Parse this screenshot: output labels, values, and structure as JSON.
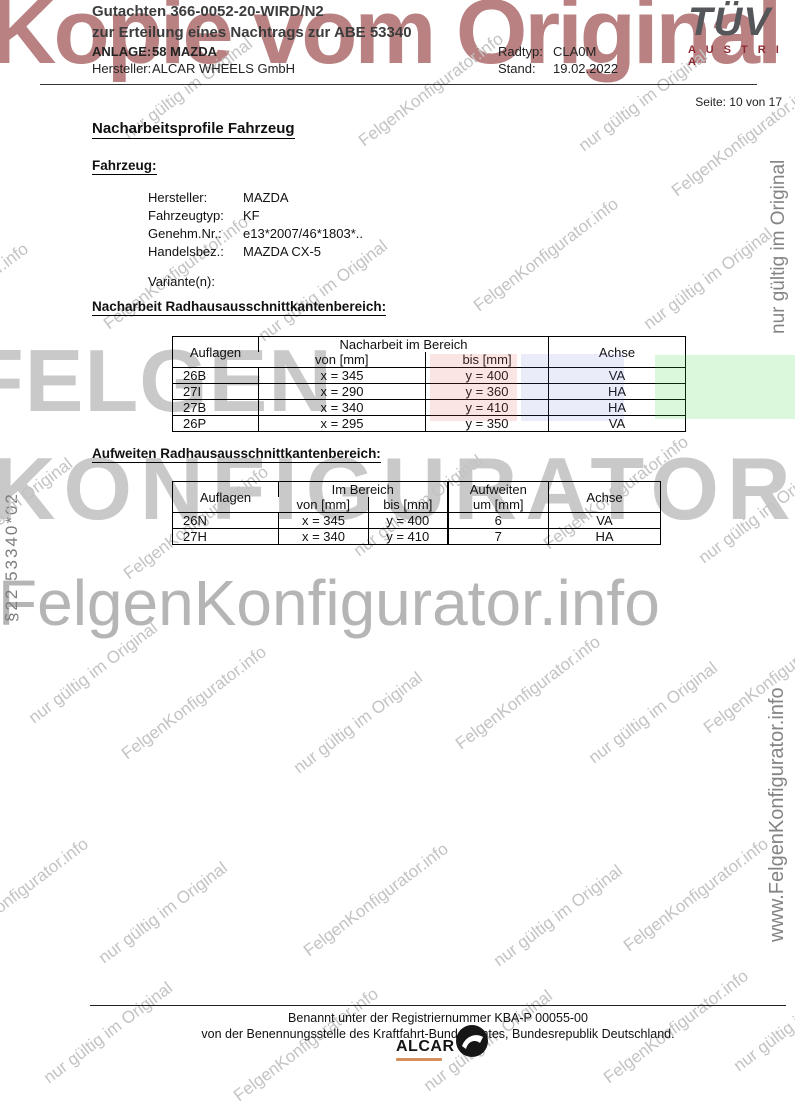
{
  "header": {
    "title_line1": "Gutachten 366-0052-20-WIRD/N2",
    "title_line2": "zur Erteilung eines Nachtrags zur ABE 53340",
    "anlage_label": "ANLAGE:",
    "anlage_value": "58 MAZDA",
    "hersteller_label": "Hersteller:",
    "hersteller_value": "ALCAR WHEELS GmbH",
    "radtyp_label": "Radtyp:",
    "radtyp_value": "CLA0M",
    "stand_label": "Stand:",
    "stand_value": "19.02.2022",
    "page_info": "Seite: 10 von 17"
  },
  "logo": {
    "tuv": "TÜV",
    "austria": "A U S T R I A"
  },
  "watermarks": {
    "kopie": "Kopie vom Original",
    "felgen_line1": "FELGEN",
    "felgen_line2": "KONFIGURATOR",
    "felgen_info_large": "FelgenKonfigurator.info",
    "left_vertical": "§22  53340*02",
    "right_vertical_top": "nur gültig im Original",
    "right_vertical_bottom": "www.FelgenKonfigurator.info",
    "diag_texts": {
      "n": "nur gültig im Original",
      "f": "FelgenKonfigurator.info"
    },
    "diag_items": [
      {
        "t": "f",
        "x": -150,
        "y": 190
      },
      {
        "t": "n",
        "x": 120,
        "y": 128
      },
      {
        "t": "f",
        "x": 355,
        "y": 135
      },
      {
        "t": "n",
        "x": 575,
        "y": 140
      },
      {
        "t": "f",
        "x": 668,
        "y": 185
      },
      {
        "t": "f",
        "x": -120,
        "y": 345
      },
      {
        "t": "f",
        "x": 100,
        "y": 318
      },
      {
        "t": "n",
        "x": 255,
        "y": 330
      },
      {
        "t": "f",
        "x": 470,
        "y": 300
      },
      {
        "t": "n",
        "x": 640,
        "y": 318
      },
      {
        "t": "n",
        "x": -60,
        "y": 548
      },
      {
        "t": "f",
        "x": 120,
        "y": 568
      },
      {
        "t": "n",
        "x": 350,
        "y": 545
      },
      {
        "t": "f",
        "x": 540,
        "y": 538
      },
      {
        "t": "n",
        "x": 695,
        "y": 552
      },
      {
        "t": "n",
        "x": 25,
        "y": 712
      },
      {
        "t": "f",
        "x": 118,
        "y": 748
      },
      {
        "t": "n",
        "x": 290,
        "y": 762
      },
      {
        "t": "f",
        "x": 452,
        "y": 738
      },
      {
        "t": "n",
        "x": 585,
        "y": 752
      },
      {
        "t": "f",
        "x": 700,
        "y": 722
      },
      {
        "t": "f",
        "x": -60,
        "y": 940
      },
      {
        "t": "n",
        "x": 95,
        "y": 952
      },
      {
        "t": "f",
        "x": 300,
        "y": 945
      },
      {
        "t": "n",
        "x": 490,
        "y": 955
      },
      {
        "t": "f",
        "x": 620,
        "y": 940
      },
      {
        "t": "n",
        "x": 40,
        "y": 1072
      },
      {
        "t": "f",
        "x": 230,
        "y": 1090
      },
      {
        "t": "n",
        "x": 420,
        "y": 1080
      },
      {
        "t": "f",
        "x": 600,
        "y": 1072
      },
      {
        "t": "n",
        "x": 730,
        "y": 1060
      }
    ]
  },
  "content": {
    "page_title": "Nacharbeitsprofile Fahrzeug",
    "fahrzeug_heading": "Fahrzeug:",
    "fahrzeug_fields": [
      {
        "label": "Hersteller:",
        "value": "MAZDA"
      },
      {
        "label": "Fahrzeugtyp:",
        "value": "KF"
      },
      {
        "label": "Genehm.Nr.:",
        "value": "e13*2007/46*1803*.."
      },
      {
        "label": "Handelsbez.:",
        "value": "MAZDA CX-5"
      }
    ],
    "varianten_label": "Variante(n):",
    "table1": {
      "heading": "Nacharbeit Radhausausschnittkantenbereich:",
      "col_auflagen": "Auflagen",
      "col_bereich": "Nacharbeit im Bereich",
      "col_von": "von [mm]",
      "col_bis": "bis [mm]",
      "col_achse": "Achse",
      "rows": [
        {
          "auflage": "26B",
          "von": "x = 345",
          "bis": "y = 400",
          "achse": "VA"
        },
        {
          "auflage": "27I",
          "von": "x = 290",
          "bis": "y = 360",
          "achse": "HA"
        },
        {
          "auflage": "27B",
          "von": "x = 340",
          "bis": "y = 410",
          "achse": "HA"
        },
        {
          "auflage": "26P",
          "von": "x = 295",
          "bis": "y = 350",
          "achse": "VA"
        }
      ]
    },
    "table2": {
      "heading": "Aufweiten Radhausausschnittkantenbereich:",
      "col_auflagen": "Auflagen",
      "col_bereich": "Im Bereich",
      "col_von": "von [mm]",
      "col_bis": "bis [mm]",
      "col_aufweiten_line1": "Aufweiten",
      "col_aufweiten_line2": "um [mm]",
      "col_achse": "Achse",
      "rows": [
        {
          "auflage": "26N",
          "von": "x = 345",
          "bis": "y = 400",
          "um": "6",
          "achse": "VA"
        },
        {
          "auflage": "27H",
          "von": "x = 340",
          "bis": "y = 410",
          "um": "7",
          "achse": "HA"
        }
      ]
    }
  },
  "footer": {
    "line1": "Benannt unter der Registriernummer KBA-P 00055-00",
    "line2": "von der Benennungsstelle des Kraftfahrt-Bundesamtes, Bundesrepublik Deutschland.",
    "alcar": "ALCAR"
  },
  "colors": {
    "kopie_red": "#a76262",
    "watermark_gray": "#c9c9c9",
    "tuv_gray": "#55565a",
    "austria_red": "#8c2a33",
    "highlight_pink": "#f2dcdc",
    "highlight_blue": "#e2e5f2",
    "highlight_green": "#d9f4d9"
  }
}
